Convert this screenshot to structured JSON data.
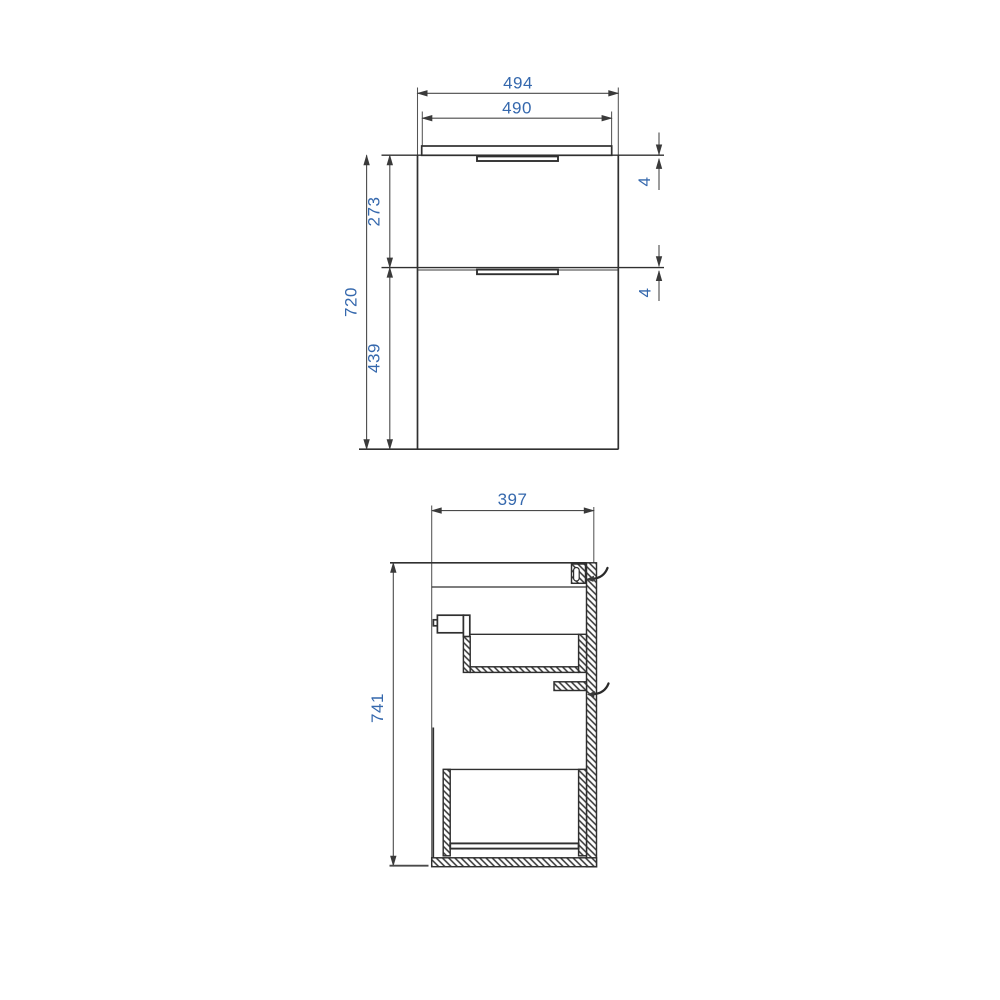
{
  "front_view": {
    "top_width": "494",
    "cabinet_width": "490",
    "total_height": "720",
    "upper_drawer_height": "273",
    "lower_drawer_height": "439",
    "top_gap": "4",
    "middle_gap": "4"
  },
  "side_view": {
    "depth": "397",
    "total_height": "741"
  },
  "colors": {
    "background": "#ffffff",
    "object_line": "#303030",
    "dimension_line": "#4a4a4a",
    "dimension_text": "#3568ad"
  }
}
